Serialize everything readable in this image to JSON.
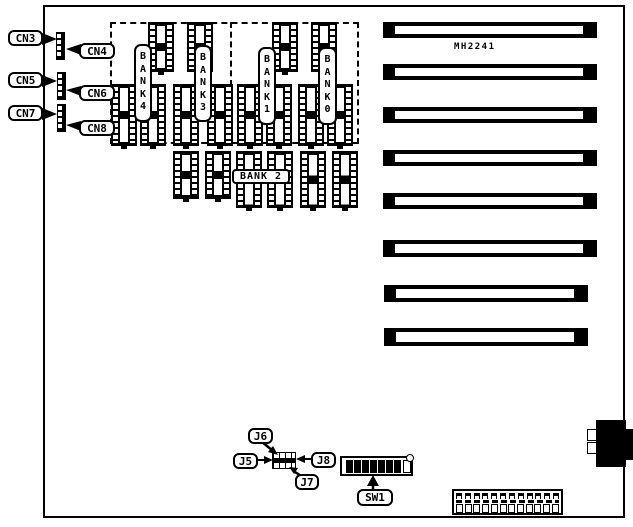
{
  "board": {
    "model_label": "MH2241"
  },
  "edge_connectors": {
    "cn3": "CN3",
    "cn5": "CN5",
    "cn7": "CN7"
  },
  "onboard_connectors": {
    "cn4": "CN4",
    "cn6": "CN6",
    "cn8": "CN8"
  },
  "memory_banks": {
    "bank4": "BANK4",
    "bank3": "BANK3",
    "bank1": "BANK1",
    "bank0": "BANK0",
    "bank2": "BANK 2"
  },
  "jumpers": {
    "j5": "J5",
    "j6": "J6",
    "j7": "J7",
    "j8": "J8"
  },
  "switches": {
    "sw1": "SW1"
  },
  "colors": {
    "ink": "#000000",
    "paper": "#ffffff"
  },
  "structure": {
    "expansion_slot_count": 8,
    "memory_socket_count": 18,
    "sw1_filled_cells": 7,
    "sw1_open_cells": 1,
    "power_top_pin_count": 12,
    "power_bottom_pin_count": 12,
    "edge_connector_pin_count": 4
  }
}
